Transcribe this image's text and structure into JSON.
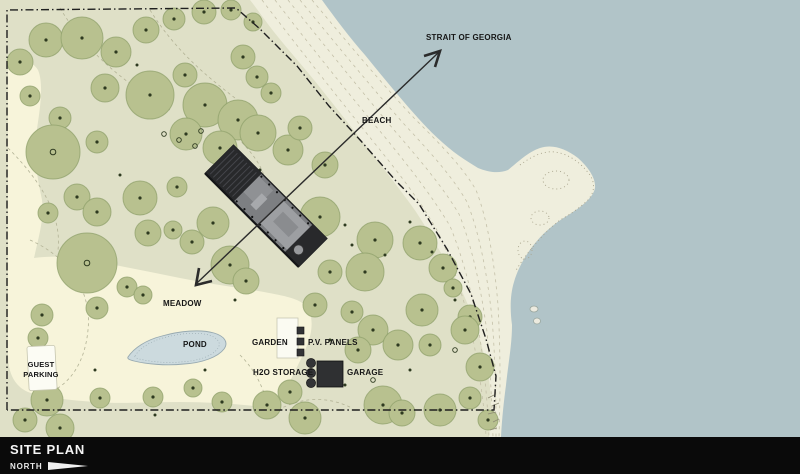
{
  "map": {
    "labels": {
      "strait_of_georgia": "STRAIT OF GEORGIA",
      "beach": "BEACH",
      "meadow": "MEADOW",
      "pond": "POND",
      "garden": "GARDEN",
      "pv_panels": "P.V. PANELS",
      "h2o_storage": "H2O STORAGE",
      "garage": "GARAGE",
      "guest_parking_line1": "GUEST",
      "guest_parking_line2": "PARKING"
    },
    "colors": {
      "water": "#b1c4c8",
      "beach_sand": "#efeedd",
      "forest": "#dfe0c7",
      "meadow": "#f7f4da",
      "tree_fill": "#b8c18f",
      "tree_stroke": "#8fa06b",
      "tree_dot": "#2e3a20",
      "pond_fill": "#ccdade",
      "pond_stroke": "#97a9b0",
      "building_body": "#7d7f82",
      "building_dark": "#28292b",
      "structure_dark": "#333436",
      "boundary_line": "#1f1f1f",
      "contour_line": "#c4c0a8",
      "label_text": "#161616",
      "footer_bg": "#0a0a0a",
      "footer_text": "#f5f5f5"
    },
    "trees": [
      [
        20,
        62,
        13
      ],
      [
        46,
        40,
        17
      ],
      [
        82,
        38,
        21
      ],
      [
        116,
        52,
        15
      ],
      [
        146,
        30,
        13
      ],
      [
        174,
        19,
        11
      ],
      [
        204,
        12,
        12
      ],
      [
        231,
        10,
        10
      ],
      [
        253,
        22,
        9
      ],
      [
        105,
        88,
        14
      ],
      [
        60,
        118,
        11
      ],
      [
        30,
        96,
        10
      ],
      [
        150,
        95,
        24
      ],
      [
        185,
        75,
        12
      ],
      [
        53,
        152,
        27
      ],
      [
        97,
        142,
        11
      ],
      [
        243,
        57,
        12
      ],
      [
        257,
        77,
        11
      ],
      [
        271,
        93,
        10
      ],
      [
        205,
        105,
        22
      ],
      [
        238,
        120,
        20
      ],
      [
        186,
        134,
        16
      ],
      [
        220,
        148,
        17
      ],
      [
        258,
        133,
        18
      ],
      [
        288,
        150,
        15
      ],
      [
        300,
        128,
        12
      ],
      [
        325,
        165,
        13
      ],
      [
        320,
        217,
        20
      ],
      [
        375,
        240,
        18
      ],
      [
        420,
        243,
        17
      ],
      [
        365,
        272,
        19
      ],
      [
        443,
        268,
        14
      ],
      [
        330,
        272,
        12
      ],
      [
        453,
        288,
        9
      ],
      [
        315,
        305,
        12
      ],
      [
        422,
        310,
        16
      ],
      [
        470,
        317,
        12
      ],
      [
        77,
        197,
        13
      ],
      [
        97,
        212,
        14
      ],
      [
        48,
        213,
        10
      ],
      [
        140,
        198,
        17
      ],
      [
        177,
        187,
        10
      ],
      [
        148,
        233,
        13
      ],
      [
        173,
        230,
        9
      ],
      [
        213,
        223,
        16
      ],
      [
        192,
        242,
        12
      ],
      [
        230,
        265,
        19
      ],
      [
        87,
        263,
        30
      ],
      [
        127,
        287,
        10
      ],
      [
        143,
        295,
        9
      ],
      [
        97,
        308,
        11
      ],
      [
        42,
        315,
        11
      ],
      [
        246,
        281,
        13
      ],
      [
        38,
        338,
        10
      ],
      [
        373,
        330,
        15
      ],
      [
        358,
        350,
        13
      ],
      [
        398,
        345,
        15
      ],
      [
        430,
        345,
        11
      ],
      [
        352,
        312,
        11
      ],
      [
        25,
        420,
        12
      ],
      [
        60,
        428,
        14
      ],
      [
        100,
        398,
        10
      ],
      [
        47,
        400,
        16
      ],
      [
        153,
        397,
        10
      ],
      [
        193,
        388,
        9
      ],
      [
        222,
        402,
        10
      ],
      [
        267,
        405,
        14
      ],
      [
        290,
        392,
        12
      ],
      [
        305,
        418,
        16
      ],
      [
        383,
        405,
        19
      ],
      [
        402,
        413,
        13
      ],
      [
        440,
        410,
        16
      ],
      [
        470,
        398,
        11
      ],
      [
        488,
        420,
        10
      ],
      [
        465,
        330,
        14
      ],
      [
        480,
        367,
        14
      ]
    ],
    "saplings": [
      [
        137,
        65
      ],
      [
        260,
        170
      ],
      [
        300,
        250
      ],
      [
        345,
        225
      ],
      [
        385,
        255
      ],
      [
        410,
        222
      ],
      [
        352,
        245
      ],
      [
        432,
        252
      ],
      [
        455,
        300
      ],
      [
        120,
        175
      ],
      [
        235,
        300
      ],
      [
        330,
        340
      ],
      [
        410,
        370
      ],
      [
        95,
        370
      ],
      [
        205,
        370
      ],
      [
        155,
        415
      ],
      [
        345,
        385
      ]
    ],
    "ground_markers": [
      [
        164,
        134
      ],
      [
        179,
        140
      ],
      [
        195,
        146
      ],
      [
        201,
        131
      ],
      [
        373,
        380
      ],
      [
        455,
        350
      ]
    ]
  },
  "footer": {
    "title": "SITE PLAN",
    "north_label": "NORTH"
  }
}
